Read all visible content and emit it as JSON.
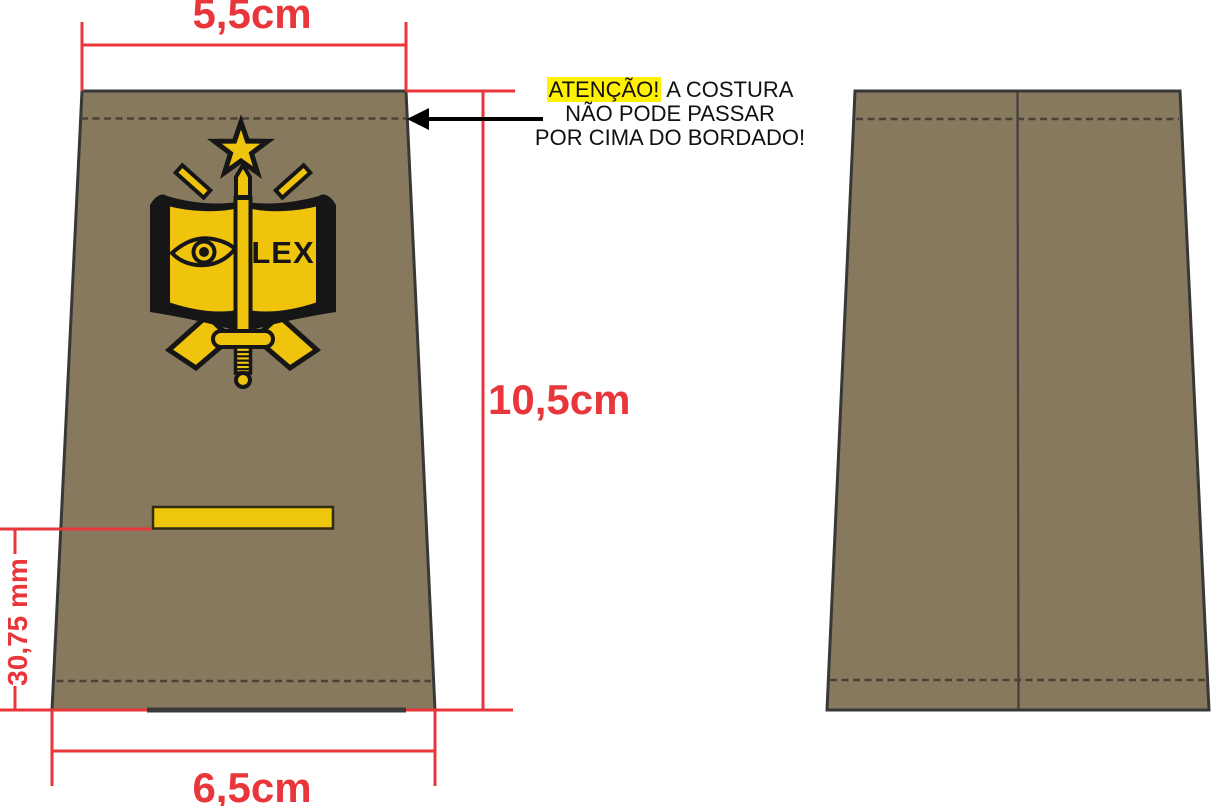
{
  "dimensions": {
    "top_width": "5,5cm",
    "total_height": "10,5cm",
    "bottom_width": "6,5cm",
    "stripe_to_bottom": "30,75 mm"
  },
  "warning": {
    "attention": "ATENÇÃO!",
    "line1_rest": " A COSTURA",
    "line2": "NÃO PODE PASSAR",
    "line3": "POR CIMA DO BORDADO!"
  },
  "emblem": {
    "motto": "LEX",
    "icons": [
      "star-icon",
      "crossed-rifles-icon",
      "open-book-icon",
      "eye-icon",
      "sword-icon"
    ]
  },
  "colors": {
    "fabric": "#87795E",
    "fabric_outline": "#383838",
    "gold": "#F0C40D",
    "dimension_red": "#E8363B",
    "highlight_yellow": "#FFF100",
    "text_black": "#111111"
  }
}
